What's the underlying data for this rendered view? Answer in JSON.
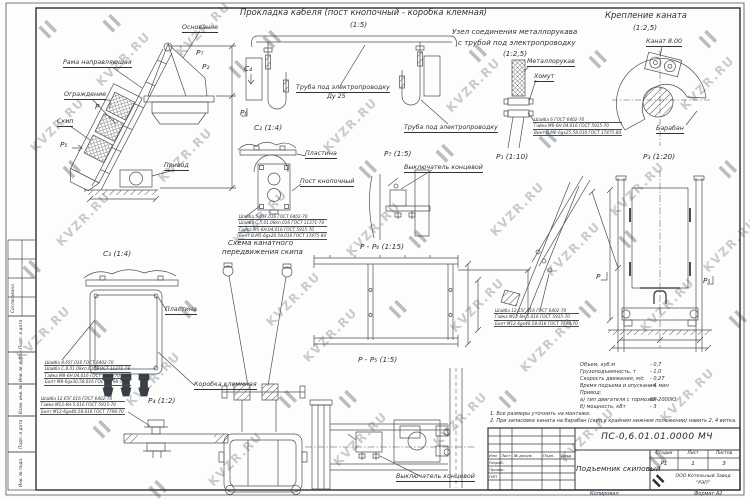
{
  "sheet": {
    "watermark": "KVZR.RU",
    "copied": "Копировал",
    "format": "Формат А2",
    "side_stamp": [
      "Согласовано",
      "Подп. и дата",
      "Инв. № дубл.",
      "Взам. инв. №",
      "Подп. и дата",
      "Инв. № подл."
    ]
  },
  "titles": {
    "cable_routing": "Прокладка кабеля (пост кнопочный - коробка клемная)",
    "cable_routing_scale": "(1:5)",
    "hose_unit_1": "Узел соединения металлорукава",
    "hose_unit_2": "с трубой под электропроводку",
    "hose_unit_scale": "(1:2,5)",
    "rope_fastening": "Крепление каната",
    "rope_fastening_scale": "(1:2,5)",
    "rope_scheme_1": "Схема канатного",
    "rope_scheme_2": "передвижения скипа"
  },
  "labels": {
    "osnovanie": "Основание",
    "rama": "Рама направляющая",
    "ograzhdenie": "Ограждение",
    "skip": "Скип",
    "privod": "Привод",
    "metallorukav": "Металлорукав",
    "homut": "Хомут",
    "truba1": "Труба под электропроводку",
    "du25": "Ду 25",
    "truba2": "Труба под электропроводку",
    "kanat": "Канат 8.00",
    "baraban": "Барабан",
    "plastina1": "Пластина",
    "post": "Пост кнопочный",
    "vykl1": "Выключатель концевой",
    "plastina2": "Пластина",
    "korobka": "Коробка клеммная",
    "vykl2": "Выключатель концевой"
  },
  "marks": {
    "c4": "C₄",
    "p6": "P₆",
    "p2": "P₂",
    "p7m": "P₇",
    "p_main": "P",
    "p5_main": "P₅",
    "c2": "C₂ (1:4)",
    "p7": "P₇ (1:5)",
    "p1": "P₁ (1:10)",
    "p3": "P₃ (1:20)",
    "c3": "C₃ (1:4)",
    "p4": "P₄ (1:2)",
    "pp6": "P - P₆ (1:15)",
    "pp5": "P - P₅ (1:5)",
    "p_small": "P",
    "p5_small": "P₅"
  },
  "fasteners": {
    "hose": [
      "Шайба 6 ГОСТ 6402-70",
      "Гайка М6-6Н.04.016 ГОСТ 5915-70",
      "Винт В.М6-6gх25.58.016 ГОСТ 17475-80"
    ],
    "c2": [
      "Шайба 5.65Г.016 ГОСТ 6402-70",
      "Шайба С.5.01.08кп.016 ГОСТ 11371-78",
      "Гайка М5-6Н.04.016 ГОСТ 5915-70",
      "Винт В.М5-6gх20.58.016 ГОСТ 17475-80"
    ],
    "c3": [
      "Шайба 8.65Г.016 ГОСТ 6402-70",
      "Шайба С.8.01.08кп.016 ГОСТ 11371-78",
      "Гайка М8-6Н.04.016 ГОСТ 5915-70",
      "Болт М8-6gх30.58.016 ГОСТ 7798-70"
    ],
    "p4": [
      "Шайба 12.65Г.016 ГОСТ 6402-70",
      "Гайка М12-6Н.5.016 ГОСТ 5915-70",
      "Болт М12-6gх40.58.016 ГОСТ 7798-70"
    ],
    "p1": [
      "Шайба 12.65Г.016 ГОСТ 6402-70",
      "Гайка М12-6Н.5.016 ГОСТ 5915-70",
      "Болт М12-6gх40.58.016 ГОСТ 7798-70"
    ]
  },
  "specs": {
    "rows": [
      {
        "label": "Объем, куб.м",
        "value": "- 0,7"
      },
      {
        "label": "Грузоподъемность, т",
        "value": "- 1,0"
      },
      {
        "label": "Скорость движения, м/с",
        "value": "- 0,27"
      },
      {
        "label": "Время подъема и опускания, мин",
        "value": "- 4"
      },
      {
        "label": "Привод:",
        "value": ""
      },
      {
        "label": "а) тип двигателя с тормозом",
        "value": "КГ-2000Ю"
      },
      {
        "label": "б) мощность, кВт",
        "value": "- 3"
      }
    ]
  },
  "notes": [
    "1. Все размеры уточнить на монтаже.",
    "2. При запасовке каната на барабан (скип в крайнем нижнем положении) навить 2, 4 витка."
  ],
  "title_block": {
    "doc_number": "ПС-0,6.01.01.0000 МЧ",
    "doc_title": "Подъемник скиповый",
    "stage_header": "Стадия",
    "sheet_header": "Лист",
    "sheets_header": "Листов",
    "stage": "Р1",
    "sheet": "1",
    "sheets": "3",
    "company_1": "ООО Котельный Завод",
    "company_2": "\"РЭП\"",
    "col_izm": "Изм",
    "col_list": "Лист",
    "col_doc": "№ докум.",
    "col_podp": "Подп.",
    "col_data": "Дата",
    "role_1": "Разраб.",
    "role_2": "Провер.",
    "role_3": "ГИП"
  }
}
